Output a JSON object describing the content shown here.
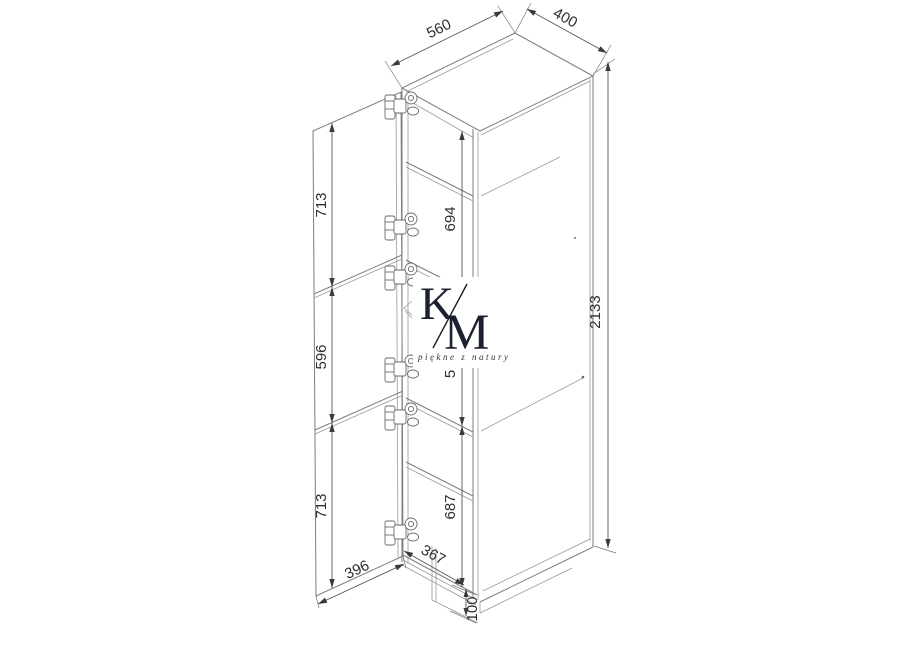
{
  "drawing": {
    "title_hint": "tall-cabinet-technical-drawing",
    "dims": {
      "top_depth": "560",
      "top_width": "400",
      "height_total": "2133",
      "door_top": "713",
      "door_middle": "596",
      "door_bottom": "713",
      "interior_top": "694",
      "interior_middle_partial": "5",
      "interior_bottom": "687",
      "door_width": "396",
      "interior_width": "367",
      "plinth_height": "100"
    },
    "watermark": {
      "letter_k": "K",
      "letter_m": "M",
      "tagline": "piękne z natury"
    },
    "colors": {
      "line": "#7d7d7d",
      "dimension_line": "#555555",
      "text": "#2e2e2e",
      "watermark": "#1b2130",
      "background": "#ffffff"
    }
  }
}
